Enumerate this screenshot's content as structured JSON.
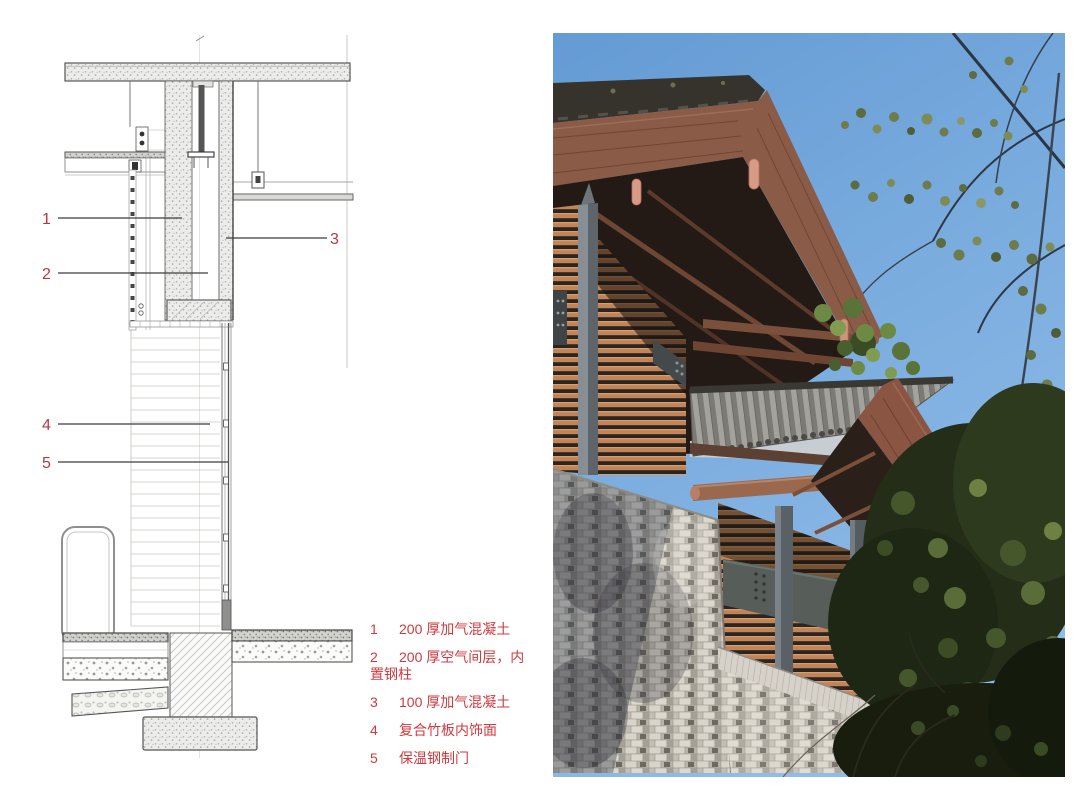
{
  "colors": {
    "callout_red": "#b43a3f",
    "legend_red": "#d0393f",
    "sky_blue": "#74a8de",
    "roof_wood": "#8a5b47",
    "louver_tan": "#c08458",
    "steel_gray": "#5d646a",
    "brick_light": "#ccc8bf",
    "foliage_green": "#5c6b40"
  },
  "drawing": {
    "callouts": [
      "1",
      "2",
      "3",
      "4",
      "5"
    ]
  },
  "legend": {
    "items": [
      {
        "num": "1",
        "text": "200 厚加气混凝土"
      },
      {
        "num": "2",
        "text": "200 厚空气间层，内置钢柱"
      },
      {
        "num": "3",
        "text": "100 厚加气混凝土"
      },
      {
        "num": "4",
        "text": "复合竹板内饰面"
      },
      {
        "num": "5",
        "text": "保温钢制门"
      }
    ]
  }
}
